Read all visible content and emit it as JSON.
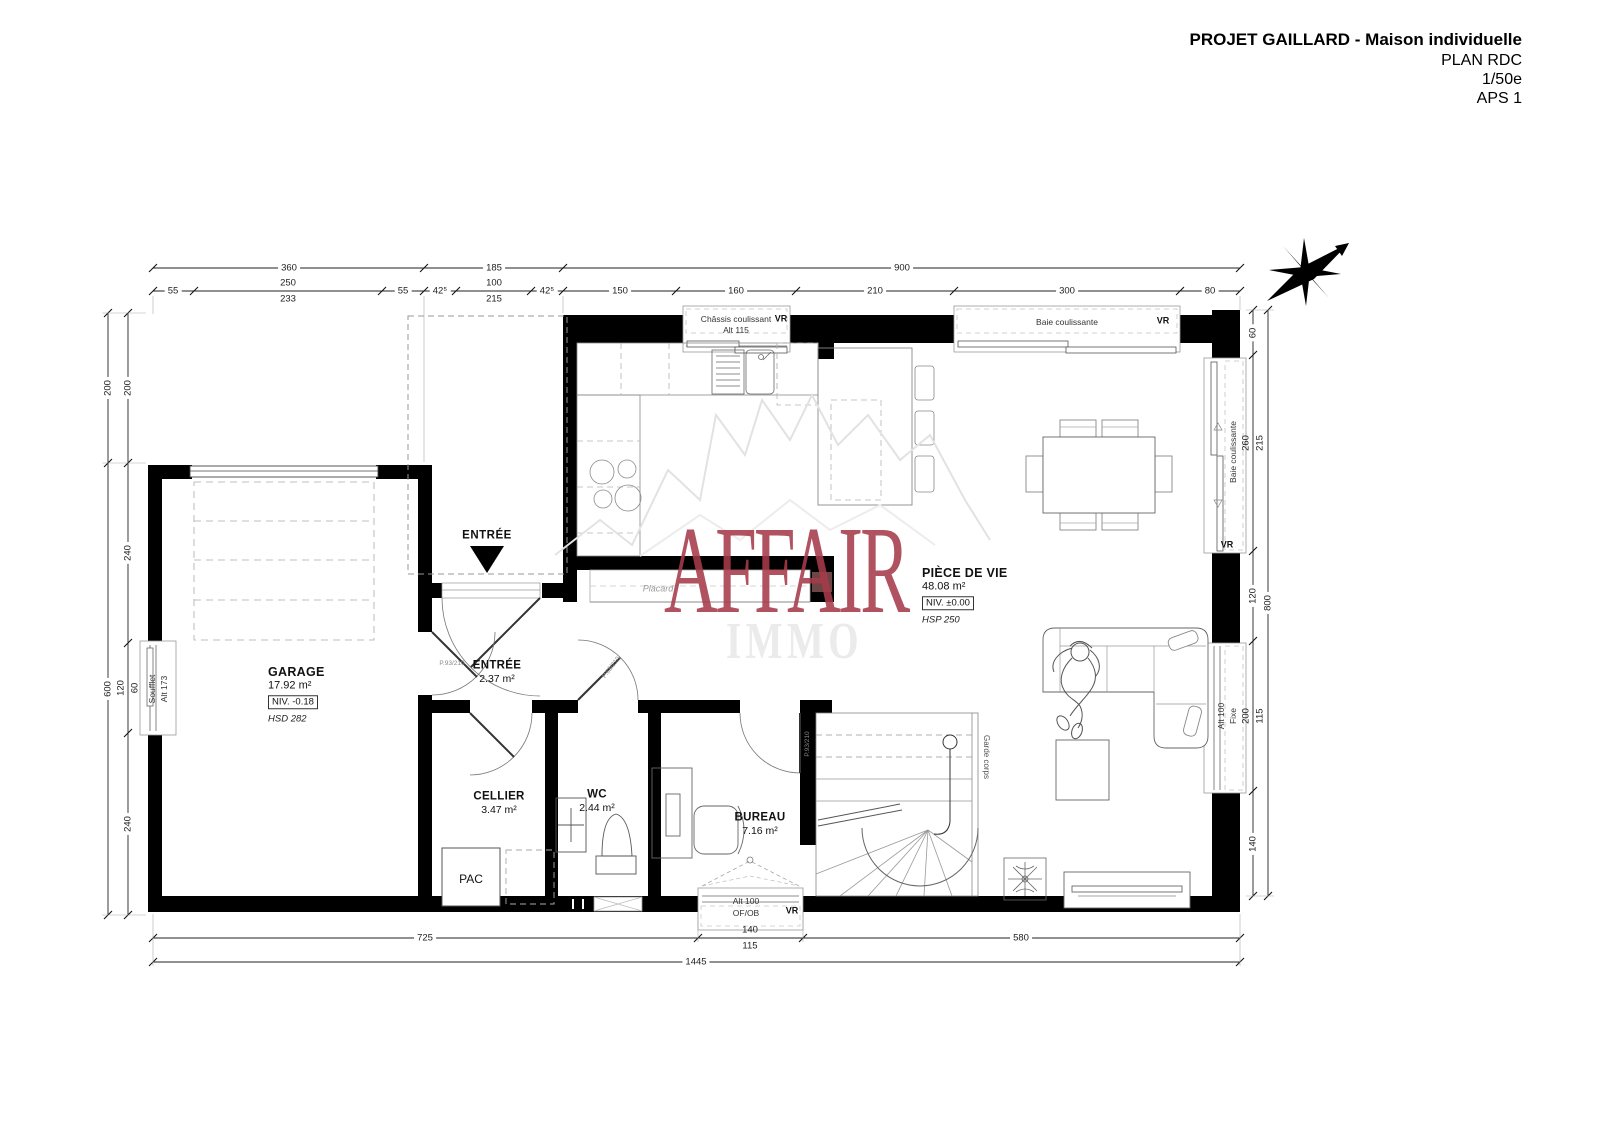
{
  "title_block": {
    "project": "PROJET GAILLARD - Maison individuelle",
    "plan": "PLAN RDC",
    "scale": "1/50e",
    "phase": "APS 1"
  },
  "rooms": {
    "garage": {
      "name": "GARAGE",
      "area": "17.92 m²",
      "level": "NIV. -0.18",
      "height": "HSD 282"
    },
    "entree": {
      "name": "ENTRÉE",
      "area": "2.37 m²"
    },
    "cellier": {
      "name": "CELLIER",
      "area": "3.47 m²"
    },
    "wc": {
      "name": "WC",
      "area": "2.44 m²"
    },
    "bureau": {
      "name": "BUREAU",
      "area": "7.16 m²"
    },
    "piece_de_vie": {
      "name": "PIÈCE DE VIE",
      "area": "48.08 m²",
      "level": "NIV. ±0.00",
      "height": "HSP 250"
    }
  },
  "annotations": {
    "entree_arrow": "ENTRÉE",
    "placard": "Placard",
    "pac": "PAC",
    "garde_corps": "Garde corps",
    "soufflet": {
      "l1": "Soufflet",
      "l2": "Alt 173"
    },
    "chassis": {
      "l1": "Châssis coulissant",
      "l2": "Alt 115"
    },
    "baie_top": "Baie coulissante",
    "baie_right": "Baie coulissante",
    "fixe_right": {
      "l1": "Alt 100",
      "l2": "Fixe"
    },
    "ofob": {
      "l1": "Alt 100",
      "l2": "OF/OB"
    },
    "vr": "VR",
    "door_garage": "P.93/210",
    "door_wc": "P.63/210",
    "door_bureau": "P.93/210"
  },
  "dimensions": {
    "top1": [
      "360",
      "185",
      "900"
    ],
    "top2": [
      "55",
      "250",
      "233",
      "55",
      "42⁵",
      "100",
      "215",
      "42⁵",
      "150",
      "160",
      "210",
      "300",
      "80"
    ],
    "left_outer": [
      "200",
      "600"
    ],
    "left_inner": [
      "200",
      "240",
      "120",
      "60",
      "240"
    ],
    "right_inner": [
      "60",
      "260",
      "215",
      "120",
      "200",
      "115",
      "140"
    ],
    "right_outer": [
      "800"
    ],
    "bottom1": [
      "725",
      "140",
      "115",
      "580"
    ],
    "bottom2": [
      "1445"
    ]
  },
  "watermark": {
    "brand": "AFFAIR",
    "sub": "IMMO",
    "brand_color": "#a63b4b"
  }
}
